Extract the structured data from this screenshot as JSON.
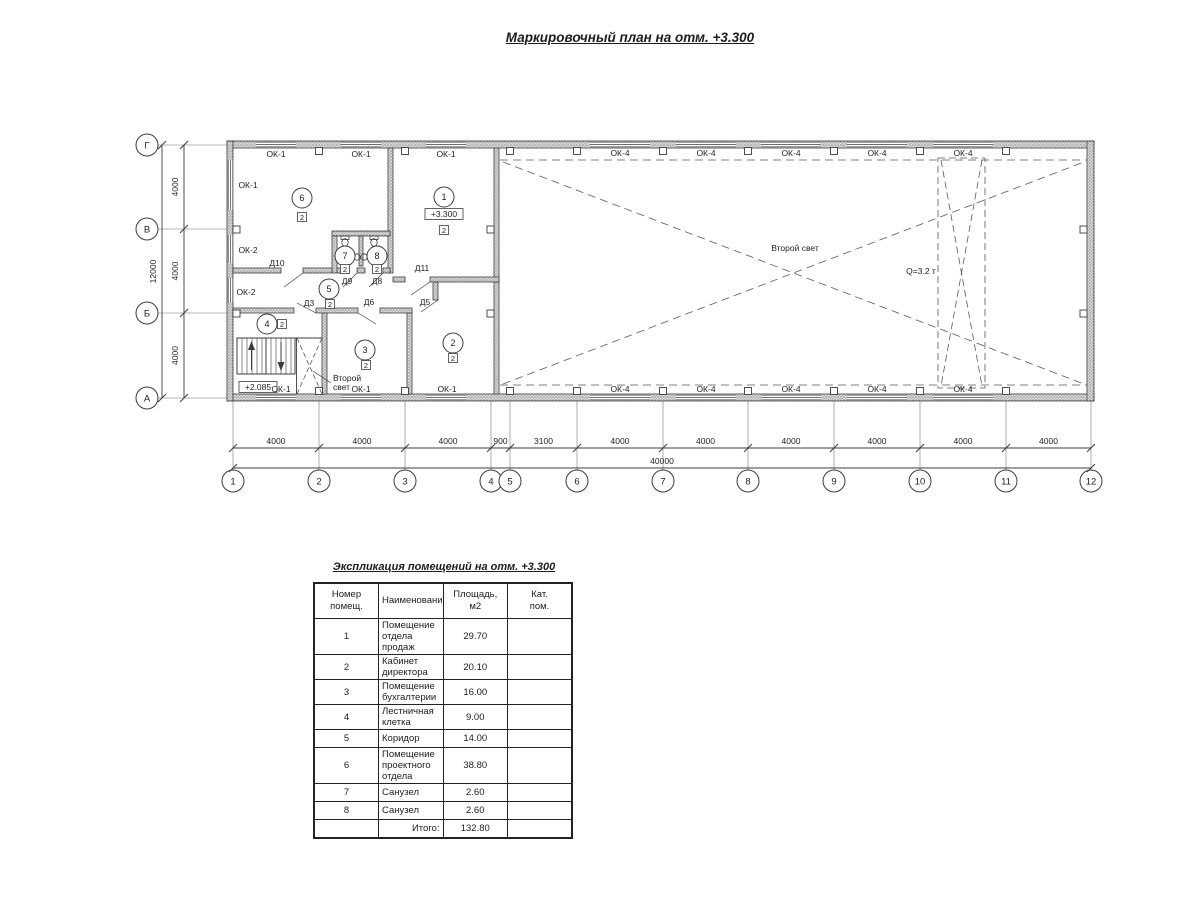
{
  "page": {
    "plan_title": "Маркировочный план на отм. +3.300",
    "table_title": "Экспликация помещений на отм. +3.300"
  },
  "plan": {
    "axes_cols": [
      {
        "label": "1",
        "x": 233
      },
      {
        "label": "2",
        "x": 319
      },
      {
        "label": "3",
        "x": 405
      },
      {
        "label": "4",
        "x": 491
      },
      {
        "label": "5",
        "x": 510
      },
      {
        "label": "6",
        "x": 577
      },
      {
        "label": "7",
        "x": 663
      },
      {
        "label": "8",
        "x": 748
      },
      {
        "label": "9",
        "x": 834
      },
      {
        "label": "10",
        "x": 920
      },
      {
        "label": "11",
        "x": 1006
      },
      {
        "label": "12",
        "x": 1091
      }
    ],
    "axes_rows": [
      {
        "label": "Г",
        "y": 145
      },
      {
        "label": "В",
        "y": 229
      },
      {
        "label": "Б",
        "y": 313
      },
      {
        "label": "А",
        "y": 398
      }
    ],
    "dims_bottom": [
      "4000",
      "4000",
      "4000",
      "900",
      "3100",
      "4000",
      "4000",
      "4000",
      "4000",
      "4000",
      "4000"
    ],
    "dim_bottom_total": "40000",
    "dims_left": [
      "4000",
      "4000",
      "4000"
    ],
    "dim_left_total": "12000",
    "window_labels": [
      {
        "t": "ОК-1",
        "x": 276,
        "y": 157
      },
      {
        "t": "ОК-1",
        "x": 361,
        "y": 157
      },
      {
        "t": "ОК-1",
        "x": 446,
        "y": 157
      },
      {
        "t": "ОК-4",
        "x": 620,
        "y": 156
      },
      {
        "t": "ОК-4",
        "x": 706,
        "y": 156
      },
      {
        "t": "ОК-4",
        "x": 791,
        "y": 156
      },
      {
        "t": "ОК-4",
        "x": 877,
        "y": 156
      },
      {
        "t": "ОК-4",
        "x": 963,
        "y": 156
      },
      {
        "t": "ОК-1",
        "x": 248,
        "y": 188
      },
      {
        "t": "ОК-2",
        "x": 248,
        "y": 253
      },
      {
        "t": "ОК-2",
        "x": 246,
        "y": 295
      },
      {
        "t": "ОК-1",
        "x": 281,
        "y": 392
      },
      {
        "t": "ОК-1",
        "x": 361,
        "y": 392
      },
      {
        "t": "ОК-1",
        "x": 447,
        "y": 392
      },
      {
        "t": "ОК-4",
        "x": 620,
        "y": 392
      },
      {
        "t": "ОК-4",
        "x": 706,
        "y": 392
      },
      {
        "t": "ОК-4",
        "x": 791,
        "y": 392
      },
      {
        "t": "ОК-4",
        "x": 877,
        "y": 392
      },
      {
        "t": "ОК-4",
        "x": 963,
        "y": 392
      }
    ],
    "door_labels": [
      {
        "t": "Д10",
        "x": 277,
        "y": 266
      },
      {
        "t": "Д9",
        "x": 347,
        "y": 284
      },
      {
        "t": "Д8",
        "x": 377,
        "y": 284
      },
      {
        "t": "Д11",
        "x": 422,
        "y": 271
      },
      {
        "t": "Д3",
        "x": 309,
        "y": 306
      },
      {
        "t": "Д6",
        "x": 369,
        "y": 305
      },
      {
        "t": "Д5",
        "x": 425,
        "y": 305
      }
    ],
    "rooms": [
      {
        "n": "6",
        "x": 302,
        "y": 198
      },
      {
        "n": "1",
        "x": 444,
        "y": 197
      },
      {
        "n": "7",
        "x": 345,
        "y": 256
      },
      {
        "n": "8",
        "x": 377,
        "y": 256
      },
      {
        "n": "5",
        "x": 329,
        "y": 289
      },
      {
        "n": "4",
        "x": 267,
        "y": 324
      },
      {
        "n": "3",
        "x": 365,
        "y": 350
      },
      {
        "n": "2",
        "x": 453,
        "y": 343
      }
    ],
    "cat_squares": [
      {
        "t": "2",
        "x": 302,
        "y": 217
      },
      {
        "t": "2",
        "x": 444,
        "y": 230
      },
      {
        "t": "2",
        "x": 345,
        "y": 269
      },
      {
        "t": "2",
        "x": 377,
        "y": 269
      },
      {
        "t": "2",
        "x": 330,
        "y": 304
      },
      {
        "t": "2",
        "x": 282,
        "y": 324
      },
      {
        "t": "2",
        "x": 366,
        "y": 365
      },
      {
        "t": "2",
        "x": 453,
        "y": 358
      }
    ],
    "elev_marks": [
      {
        "t": "+3.300",
        "x": 444,
        "y": 214
      },
      {
        "t": "+2.085",
        "x": 258,
        "y": 387
      }
    ],
    "notes": [
      {
        "t": "Второй свет",
        "x": 795,
        "y": 251,
        "anchor": "middle"
      },
      {
        "t": "Q=3.2 т",
        "x": 921,
        "y": 274,
        "anchor": "middle"
      },
      {
        "t": "Второй",
        "x": 333,
        "y": 381,
        "anchor": "start"
      },
      {
        "t": "свет",
        "x": 333,
        "y": 390,
        "anchor": "start"
      }
    ]
  },
  "table": {
    "headers": [
      "Номер\nпомещ.",
      "Наименование",
      "Площадь,\nм2",
      "Кат.\nпом."
    ],
    "rows": [
      [
        "1",
        "Помещение отдела продаж",
        "29.70",
        ""
      ],
      [
        "2",
        "Кабинет директора",
        "20.10",
        ""
      ],
      [
        "3",
        "Помещение бухгалтерии",
        "16.00",
        ""
      ],
      [
        "4",
        "Лестничная клетка",
        "9.00",
        ""
      ],
      [
        "5",
        "Коридор",
        "14.00",
        ""
      ],
      [
        "6",
        "Помещение проектного отдела",
        "38.80",
        ""
      ],
      [
        "7",
        "Санузел",
        "2.60",
        ""
      ],
      [
        "8",
        "Санузел",
        "2.60",
        ""
      ]
    ],
    "total_label": "Итого:",
    "total_value": "132.80"
  }
}
